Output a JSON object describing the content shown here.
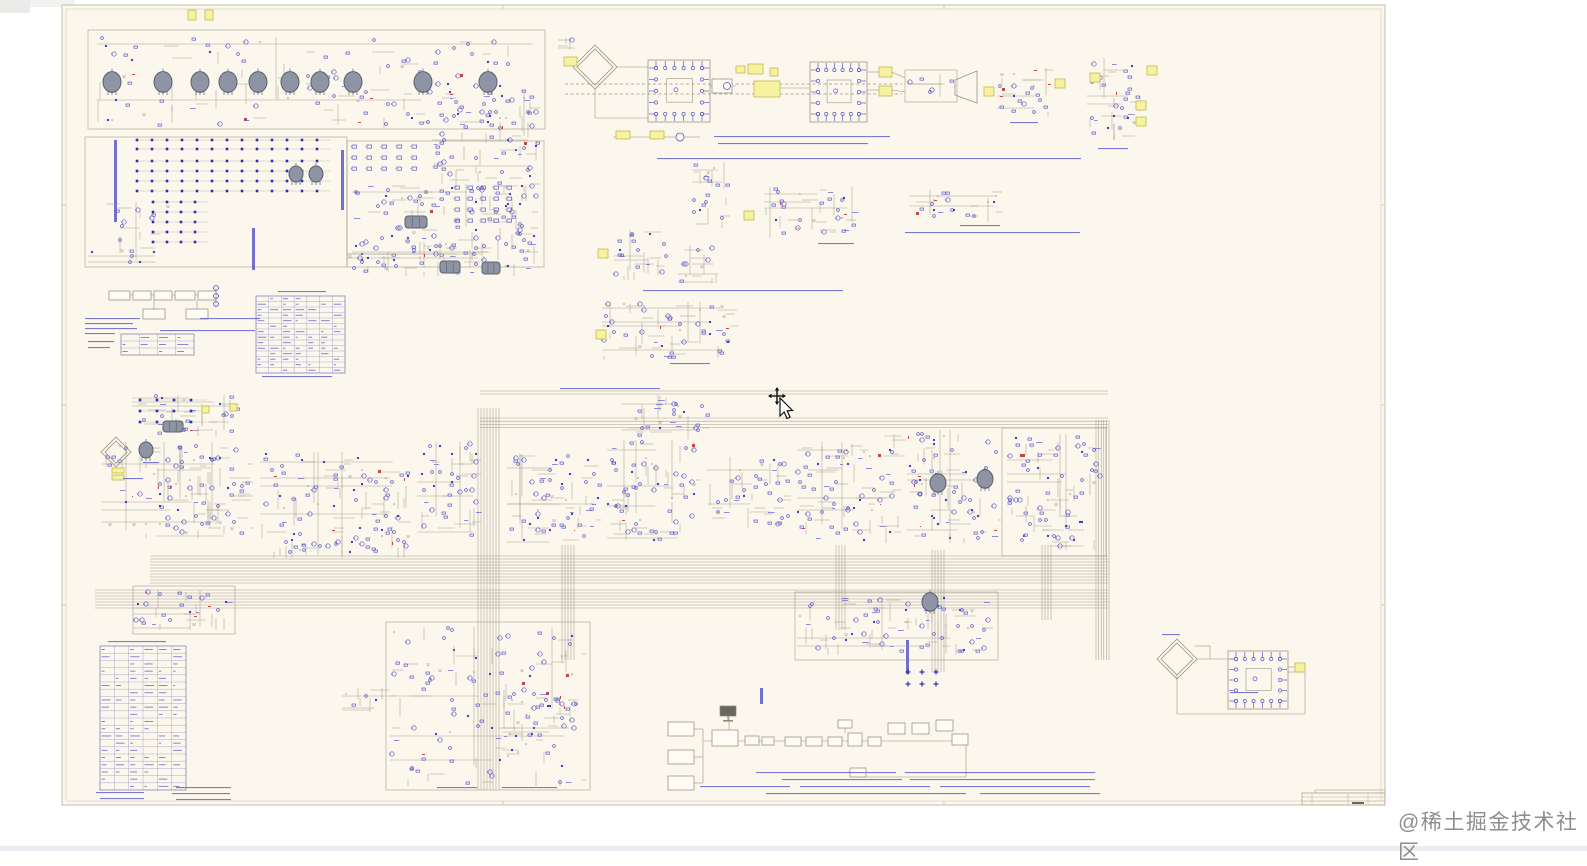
{
  "watermark": {
    "text": "@稀土掘金技术社区"
  },
  "page": {
    "width": 1587,
    "height": 851,
    "background": "#ffffff",
    "bottom_strip": [
      0,
      846,
      1587,
      5,
      "#e9edf2"
    ],
    "gray_patches": [
      [
        0,
        0,
        75,
        7,
        "#f2f2f0"
      ],
      [
        0,
        0,
        30,
        13,
        "#ebebe9"
      ]
    ]
  },
  "sheet": {
    "x": 62,
    "y": 5,
    "width": 1323,
    "height": 800,
    "background": "#fbf7ec",
    "border_color": "#c6bfaf",
    "inner_border_color": "#ded7c7",
    "ticks_x": [
      503,
      944
    ],
    "ticks_y": [
      205,
      405,
      605
    ]
  },
  "palette": {
    "wire": "#9b9486",
    "blue": "#5b58c8",
    "deep_blue": "#2e2eb2",
    "red": "#c24848",
    "tube_fill": "#8e94a4",
    "tube_stroke": "#596070",
    "yellow_fill": "#f7f2a0",
    "yellow_stroke": "#c2b852",
    "table_line": "#8585bb",
    "box_fill": "#fdfbf3",
    "box_stroke": "#8f897c",
    "title_line": "#b3ab9b"
  },
  "cursor": {
    "x": 768,
    "y": 386
  },
  "schematic": {
    "seed": 7,
    "clusters": [
      [
        95,
        35,
        445,
        95,
        3
      ],
      [
        350,
        182,
        190,
        80,
        2
      ],
      [
        86,
        200,
        88,
        68,
        1
      ],
      [
        345,
        240,
        196,
        38,
        2
      ],
      [
        430,
        88,
        112,
        115,
        2
      ],
      [
        556,
        36,
        22,
        16,
        1
      ],
      [
        995,
        66,
        66,
        52,
        2
      ],
      [
        1085,
        56,
        62,
        86,
        2
      ],
      [
        690,
        160,
        42,
        70,
        2
      ],
      [
        762,
        185,
        96,
        55,
        2
      ],
      [
        908,
        188,
        96,
        36,
        2
      ],
      [
        612,
        228,
        62,
        54,
        2
      ],
      [
        676,
        243,
        46,
        42,
        2
      ],
      [
        600,
        300,
        140,
        62,
        2
      ],
      [
        130,
        393,
        115,
        45,
        2
      ],
      [
        100,
        440,
        140,
        100,
        1
      ],
      [
        155,
        445,
        100,
        95,
        2
      ],
      [
        258,
        450,
        155,
        110,
        2
      ],
      [
        415,
        440,
        68,
        100,
        2
      ],
      [
        505,
        452,
        98,
        95,
        2
      ],
      [
        605,
        438,
        98,
        107,
        2
      ],
      [
        705,
        455,
        88,
        75,
        2
      ],
      [
        795,
        440,
        108,
        105,
        2
      ],
      [
        905,
        428,
        98,
        117,
        2
      ],
      [
        1005,
        432,
        100,
        120,
        2
      ],
      [
        620,
        393,
        92,
        48,
        2
      ],
      [
        882,
        432,
        26,
        28,
        1
      ],
      [
        132,
        588,
        100,
        44,
        2
      ],
      [
        795,
        595,
        200,
        62,
        2
      ],
      [
        388,
        625,
        200,
        163,
        2
      ],
      [
        340,
        686,
        62,
        28,
        1
      ],
      [
        500,
        688,
        80,
        55,
        2
      ],
      [
        905,
        72,
        50,
        28,
        1
      ]
    ],
    "rect_outlines": [
      [
        88,
        30,
        457,
        99
      ],
      [
        85,
        137,
        262,
        130
      ],
      [
        347,
        141,
        197,
        126
      ],
      [
        133,
        586,
        102,
        48
      ],
      [
        386,
        622,
        204,
        168
      ],
      [
        795,
        592,
        203,
        68
      ],
      [
        1002,
        428,
        104,
        128
      ],
      [
        905,
        70,
        52,
        32
      ]
    ],
    "tubes": [
      [
        112,
        82,
        9
      ],
      [
        163,
        82,
        9
      ],
      [
        200,
        82,
        9
      ],
      [
        228,
        82,
        9
      ],
      [
        258,
        82,
        9
      ],
      [
        290,
        82,
        9
      ],
      [
        320,
        82,
        9
      ],
      [
        353,
        82,
        9
      ],
      [
        423,
        82,
        9
      ],
      [
        488,
        82,
        9
      ],
      [
        296,
        174,
        7
      ],
      [
        316,
        174,
        7
      ],
      [
        146,
        450,
        7
      ],
      [
        938,
        483,
        8
      ],
      [
        985,
        479,
        8
      ],
      [
        930,
        602,
        8
      ]
    ],
    "chips": [
      [
        405,
        216,
        22,
        12
      ],
      [
        440,
        261,
        20,
        12
      ],
      [
        482,
        262,
        18,
        12
      ],
      [
        163,
        421,
        20,
        11
      ]
    ],
    "dot_grids": [
      [
        137,
        140,
        13,
        2,
        15,
        9,
        "dot"
      ],
      [
        137,
        161,
        13,
        4,
        15,
        10,
        "dot"
      ],
      [
        153,
        202,
        4,
        5,
        14,
        10,
        "dot"
      ],
      [
        140,
        400,
        4,
        3,
        17,
        11,
        "dot"
      ],
      [
        908,
        672,
        3,
        2,
        14,
        12,
        "plus"
      ]
    ],
    "glyph_grids": [
      [
        352,
        145,
        5,
        3,
        15,
        11
      ],
      [
        455,
        186,
        5,
        4,
        13,
        11
      ]
    ],
    "yellow_tags": [
      [
        188,
        10,
        8,
        10
      ],
      [
        205,
        10,
        8,
        10
      ],
      [
        564,
        57,
        13,
        9
      ],
      [
        616,
        131,
        14,
        8
      ],
      [
        650,
        131,
        14,
        8
      ],
      [
        736,
        66,
        9,
        7
      ],
      [
        748,
        64,
        15,
        10
      ],
      [
        770,
        68,
        8,
        8
      ],
      [
        754,
        81,
        26,
        16
      ],
      [
        879,
        67,
        13,
        10
      ],
      [
        879,
        86,
        13,
        10
      ],
      [
        984,
        87,
        10,
        9
      ],
      [
        1055,
        79,
        10,
        9
      ],
      [
        1090,
        73,
        10,
        9
      ],
      [
        1147,
        66,
        10,
        9
      ],
      [
        1136,
        101,
        10,
        9
      ],
      [
        1136,
        117,
        10,
        9
      ],
      [
        598,
        249,
        10,
        9
      ],
      [
        744,
        211,
        10,
        9
      ],
      [
        596,
        330,
        10,
        9
      ],
      [
        202,
        406,
        7,
        7
      ],
      [
        230,
        404,
        7,
        7
      ],
      [
        112,
        468,
        12,
        5
      ],
      [
        112,
        475,
        12,
        5
      ],
      [
        1295,
        663,
        10,
        9
      ]
    ],
    "diamonds": [
      [
        595,
        67,
        22
      ],
      [
        116,
        452,
        15
      ],
      [
        1177,
        659,
        20
      ]
    ],
    "pin_blocks": [
      [
        648,
        60,
        62,
        62
      ],
      [
        810,
        62,
        57,
        60
      ],
      [
        1228,
        651,
        60,
        58
      ]
    ],
    "dashed_wires": [
      [
        565,
        84,
        902,
        84
      ],
      [
        565,
        94,
        902,
        94
      ]
    ],
    "buses": [
      [
        "h",
        150,
        556,
        958,
        10,
        3
      ],
      [
        "h",
        95,
        590,
        1013,
        7,
        3
      ],
      [
        "h",
        480,
        418,
        628,
        4,
        3.2
      ],
      [
        "h",
        480,
        391,
        628,
        2,
        3
      ],
      [
        "v",
        478,
        408,
        382,
        8,
        3
      ],
      [
        "v",
        562,
        545,
        115,
        5,
        3
      ],
      [
        "v",
        836,
        545,
        85,
        4,
        3
      ],
      [
        "v",
        932,
        550,
        122,
        5,
        3
      ],
      [
        "v",
        1042,
        545,
        75,
        4,
        3
      ],
      [
        "v",
        1096,
        420,
        240,
        6,
        2.6
      ]
    ],
    "blue_bars": [
      [
        114,
        140,
        3,
        82
      ],
      [
        252,
        228,
        3,
        42
      ],
      [
        341,
        150,
        3,
        60
      ],
      [
        906,
        640,
        3,
        34
      ],
      [
        760,
        688,
        3,
        16
      ]
    ],
    "horn": [
      [
        955,
        80
      ],
      [
        955,
        95
      ],
      [
        977,
        103
      ],
      [
        977,
        71
      ]
    ],
    "flow_boxes": [
      [
        109,
        291,
        21,
        9
      ],
      [
        133,
        291,
        18,
        9
      ],
      [
        154,
        291,
        18,
        9
      ],
      [
        175,
        291,
        20,
        9
      ],
      [
        198,
        291,
        18,
        9
      ],
      [
        143,
        309,
        22,
        10
      ],
      [
        186,
        309,
        22,
        10
      ],
      [
        712,
        79,
        20,
        14
      ],
      [
        668,
        722,
        26,
        14
      ],
      [
        668,
        750,
        26,
        14
      ],
      [
        668,
        776,
        26,
        14
      ],
      [
        712,
        730,
        26,
        16
      ],
      [
        745,
        736,
        14,
        9
      ],
      [
        762,
        737,
        12,
        8
      ],
      [
        785,
        737,
        16,
        9
      ],
      [
        806,
        737,
        16,
        9
      ],
      [
        828,
        737,
        14,
        9
      ],
      [
        848,
        733,
        14,
        13
      ],
      [
        868,
        737,
        13,
        9
      ],
      [
        888,
        723,
        17,
        11
      ],
      [
        912,
        723,
        17,
        11
      ],
      [
        936,
        720,
        17,
        11
      ],
      [
        838,
        720,
        14,
        8
      ],
      [
        850,
        768,
        16,
        9
      ],
      [
        952,
        734,
        16,
        11
      ]
    ],
    "monitor": {
      "x": 720,
      "y": 706,
      "w": 16,
      "h": 10
    },
    "circles": [
      [
        216,
        288,
        2.5
      ],
      [
        216,
        296,
        2.5
      ],
      [
        216,
        304,
        2.5
      ],
      [
        680,
        137,
        4
      ],
      [
        727,
        86,
        3.5
      ]
    ],
    "plain_wires": [
      [
        109,
        295,
        216,
        295
      ],
      [
        154,
        300,
        154,
        309
      ],
      [
        197,
        300,
        197,
        309
      ],
      [
        216,
        288,
        216,
        306
      ],
      [
        613,
        137,
        650,
        137
      ],
      [
        664,
        137,
        676,
        137
      ],
      [
        684,
        137,
        700,
        137
      ],
      [
        595,
        89,
        595,
        118
      ],
      [
        595,
        118,
        648,
        118
      ],
      [
        617,
        67,
        648,
        67
      ],
      [
        710,
        86,
        736,
        86
      ],
      [
        780,
        88,
        810,
        88
      ],
      [
        867,
        72,
        879,
        72
      ],
      [
        867,
        90,
        879,
        90
      ],
      [
        892,
        72,
        905,
        78
      ],
      [
        892,
        90,
        905,
        92
      ],
      [
        694,
        729,
        703,
        729
      ],
      [
        703,
        729,
        703,
        741
      ],
      [
        694,
        757,
        703,
        757
      ],
      [
        694,
        783,
        703,
        783
      ],
      [
        703,
        783,
        703,
        741
      ],
      [
        703,
        741,
        952,
        741
      ],
      [
        729,
        716,
        729,
        730
      ],
      [
        845,
        724,
        845,
        733
      ],
      [
        966,
        777,
        856,
        777
      ],
      [
        966,
        777,
        966,
        741
      ],
      [
        1197,
        659,
        1228,
        659
      ],
      [
        1288,
        667,
        1295,
        667
      ],
      [
        1177,
        674,
        1177,
        714
      ],
      [
        1177,
        714,
        1305,
        714
      ],
      [
        1305,
        714,
        1305,
        672
      ],
      [
        1305,
        672,
        1288,
        672
      ],
      [
        1195,
        646,
        1210,
        646
      ],
      [
        1210,
        646,
        1210,
        659
      ]
    ],
    "tables": [
      [
        121,
        334,
        73,
        21,
        4,
        3
      ],
      [
        256,
        296,
        89,
        77,
        7,
        14
      ],
      [
        100,
        646,
        86,
        144,
        6,
        20
      ]
    ],
    "title_block": {
      "x": 1302,
      "y": 793,
      "w": 83,
      "h": 12,
      "hlines": [
        797,
        801
      ],
      "vlines": [
        1312,
        1348,
        1368
      ],
      "ledge": [
        1315,
        790,
        70,
        3
      ],
      "smudge": [
        1352,
        802,
        12,
        2
      ]
    },
    "text_lines": [
      [
        85,
        318,
        55
      ],
      [
        85,
        323,
        48
      ],
      [
        85,
        328,
        52
      ],
      [
        85,
        333,
        30
      ],
      [
        88,
        341,
        26
      ],
      [
        88,
        347,
        22
      ],
      [
        200,
        318,
        60
      ],
      [
        160,
        330,
        95
      ],
      [
        262,
        376,
        70
      ],
      [
        278,
        291,
        48
      ],
      [
        714,
        136,
        176
      ],
      [
        718,
        143,
        150
      ],
      [
        657,
        158,
        424
      ],
      [
        905,
        232,
        175
      ],
      [
        643,
        290,
        200
      ],
      [
        670,
        363,
        40
      ],
      [
        818,
        243,
        36
      ],
      [
        960,
        225,
        40
      ],
      [
        1010,
        122,
        28
      ],
      [
        1098,
        148,
        30
      ],
      [
        1230,
        692,
        28
      ],
      [
        1162,
        634,
        18
      ],
      [
        123,
        478,
        20
      ],
      [
        143,
        462,
        16
      ],
      [
        560,
        388,
        100
      ],
      [
        756,
        772,
        140
      ],
      [
        905,
        772,
        190
      ],
      [
        782,
        779,
        120
      ],
      [
        910,
        779,
        185
      ],
      [
        700,
        786,
        90
      ],
      [
        800,
        786,
        130
      ],
      [
        940,
        786,
        150
      ],
      [
        766,
        793,
        200
      ],
      [
        980,
        793,
        120
      ],
      [
        176,
        787,
        55
      ],
      [
        96,
        792,
        48
      ],
      [
        100,
        798,
        44
      ],
      [
        172,
        793,
        58
      ],
      [
        176,
        799,
        55
      ],
      [
        437,
        787,
        40
      ],
      [
        502,
        787,
        55
      ],
      [
        108,
        641,
        58
      ]
    ]
  }
}
